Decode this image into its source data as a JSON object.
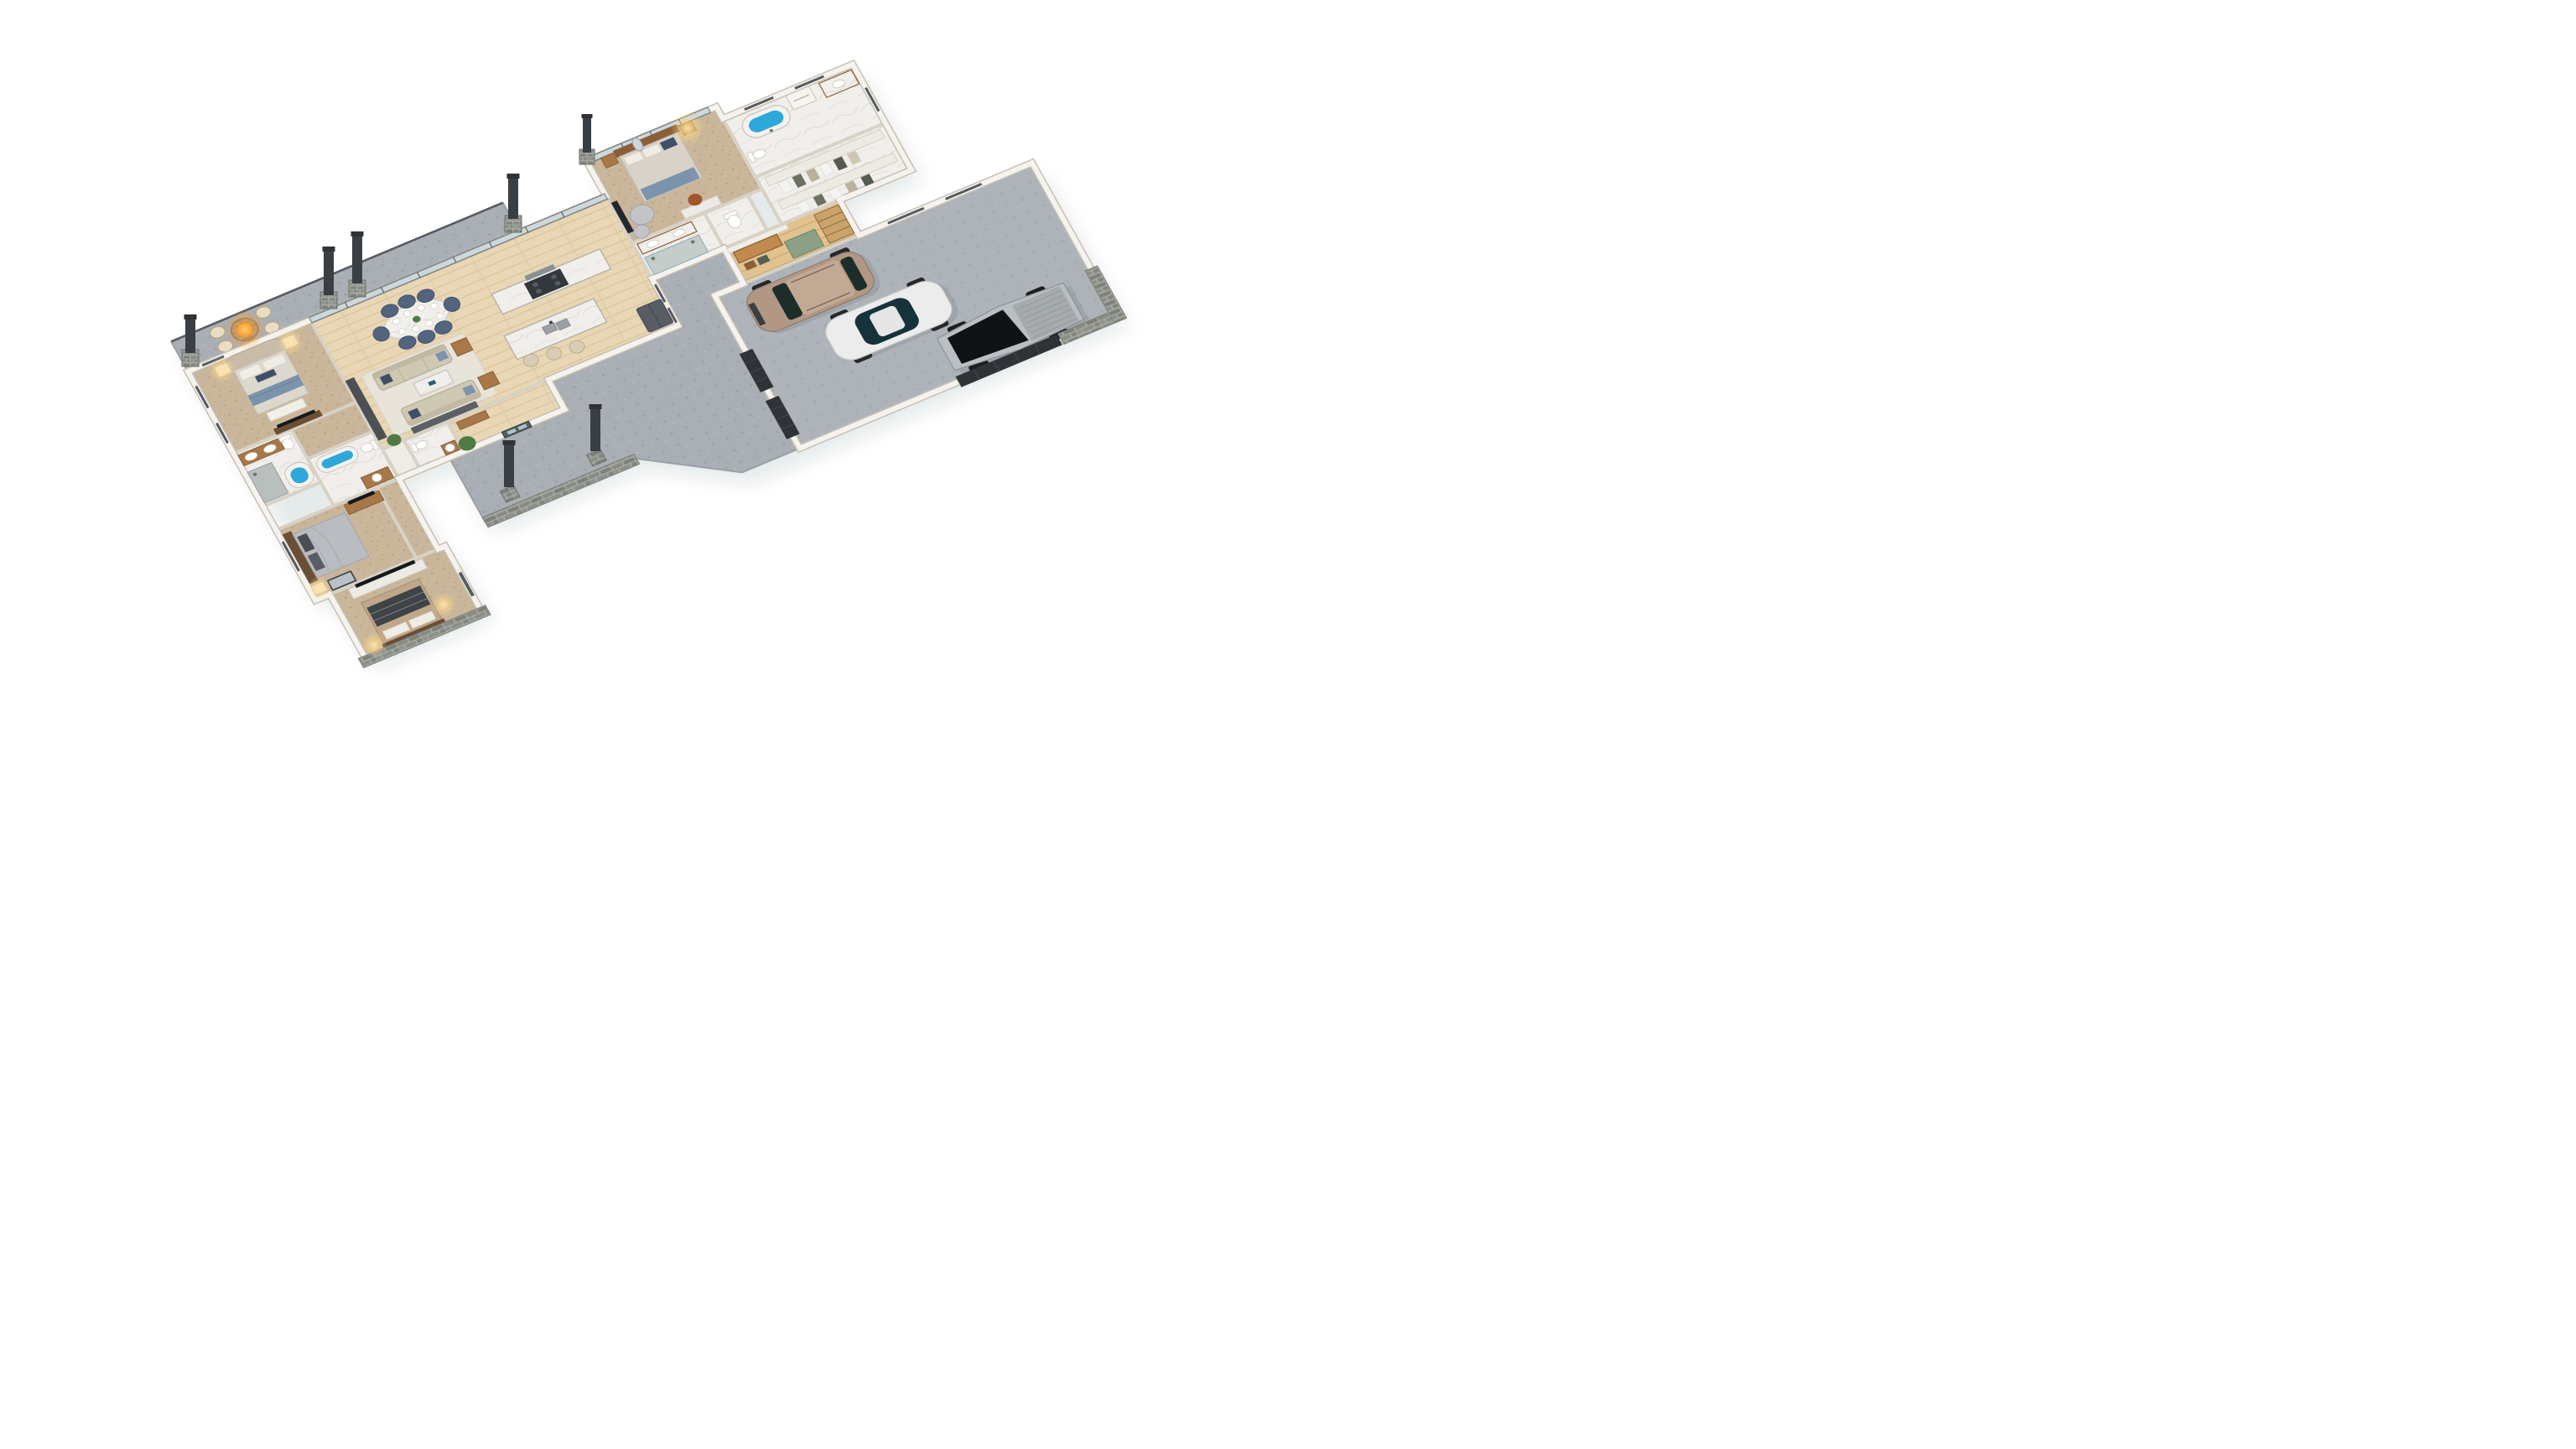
{
  "scene": {
    "title": "3D isometric floor plan render of an L-shaped single-story house",
    "view": "top-down isometric",
    "background_color": "#ffffff"
  },
  "colors": {
    "wood_floor": "#e8d6b4",
    "wood_floor_warm": "#e2c28f",
    "carpet": "#c9b69b",
    "marble_floor": "#f1efeb",
    "marble_top": "#f4f3f0",
    "concrete": "#a9afb5",
    "garage_floor": "#adb3b9",
    "wall": "#f6f3ee",
    "wall_edge": "#c6c0b4",
    "stone": "#8d9088",
    "charcoal": "#2f3337",
    "dark_feature_wall": "#4b5054",
    "navy_chair": "#53647f",
    "sofa_beige": "#cfc8b2",
    "wood_furniture": "#a87848",
    "wood_dark": "#6b4f35",
    "tub_water": "#2da8d8",
    "lamp_glow": "#ffd98a",
    "fire_glow": "#ff9a2a",
    "suv_tan": "#b29884",
    "sedan_white": "#ececec",
    "cybertruck_silver": "#b9bfc3",
    "glass": "#aac3cc",
    "green_cabinet": "#8ba085",
    "plant_green": "#4f7a43",
    "stool_beige": "#d8cdb4",
    "duvet_gray": "#b9bcc0",
    "duvet_blue": "#7c93ad",
    "duvet_tan": "#c0a78c",
    "rug": "#e9e4da"
  },
  "rooms": [
    {
      "name": "master bedroom",
      "floor": "carpet",
      "furniture": [
        "bed with arched headboard",
        "2 nightstands with lit lamps",
        "foot bench",
        "TV console",
        "windows"
      ]
    },
    {
      "name": "master bathroom",
      "floor": "marble",
      "furniture": [
        "double wood vanity",
        "walk-in shower",
        "soaking tub",
        "toilet"
      ]
    },
    {
      "name": "hall bathroom",
      "floor": "marble",
      "furniture": [
        "tub with water",
        "toilet",
        "wood vanity with round sink"
      ]
    },
    {
      "name": "bedroom 2",
      "floor": "carpet",
      "furniture": [
        "bed with gray duvet",
        "nightstand with lamp",
        "leaning mirror",
        "wood TV console"
      ]
    },
    {
      "name": "bedroom 3",
      "floor": "carpet",
      "furniture": [
        "bed with plaid throw",
        "white TV console",
        "2 lit lamps",
        "glass patio door"
      ]
    },
    {
      "name": "open plan living dining kitchen",
      "floor": "light oak wood",
      "furniture": [
        "oval marble dining table with 8 navy chairs",
        "black frame chandelier",
        "2 beige sofas",
        "marble coffee table",
        "area rug",
        "dark feature wall",
        "side tables",
        "media console",
        "kitchen island with double sink",
        "3 bar stools",
        "range with hood and oven",
        "dark refrigerator"
      ]
    },
    {
      "name": "powder room",
      "floor": "marble",
      "furniture": [
        "toilet",
        "round vessel sink on wood vanity"
      ]
    },
    {
      "name": "foyer",
      "floor": "light oak wood",
      "furniture": [
        "console table",
        "potted plant",
        "glass entry door"
      ]
    },
    {
      "name": "guest bedroom",
      "floor": "carpet",
      "furniture": [
        "bed with wood headboard",
        "2 nightstands",
        "lit lamp",
        "swivel armchair with ottoman",
        "TV on half wall",
        "desk with chair",
        "oval mirror"
      ]
    },
    {
      "name": "guest bathroom",
      "floor": "marble",
      "furniture": [
        "double sink vanity",
        "walk-in double shower"
      ]
    },
    {
      "name": "water closet",
      "floor": "marble",
      "furniture": [
        "toilet"
      ]
    },
    {
      "name": "primary bathroom",
      "floor": "marble",
      "furniture": [
        "freestanding tub with blue water",
        "toilet",
        "vanity",
        "washer"
      ]
    },
    {
      "name": "walk-in closet",
      "floor": "marble",
      "furniture": [
        "two rows of open shelves with hanging clothes"
      ]
    },
    {
      "name": "mudroom laundry",
      "floor": "warm wood",
      "furniture": [
        "wood bench with slat wall",
        "baskets",
        "sage green cabinets",
        "wood steps"
      ]
    }
  ],
  "outdoor": {
    "back_deck": {
      "floor": "gray concrete",
      "features": [
        "round fire pit with flame",
        "4 cream armchairs",
        "glass railing",
        "stone pillars with dark chimneys"
      ]
    },
    "front_porch": {
      "floor": "gray concrete",
      "features": [
        "2 freestanding stone pillars with dark posts",
        "stone half wall",
        "driveway apron"
      ]
    }
  },
  "garage": {
    "floor": "gray concrete",
    "door_count": 3,
    "door_color": "#2f3337",
    "vehicles": [
      {
        "type": "SUV",
        "color_name": "tan"
      },
      {
        "type": "sports sedan",
        "color_name": "white"
      },
      {
        "type": "angular electric pickup",
        "color_name": "silver"
      }
    ]
  },
  "counts": {
    "bedrooms": 4,
    "bathrooms": 4,
    "dining_seats": 8,
    "kitchen_stools": 3,
    "patio_chairs": 4,
    "vehicles": 3,
    "chimneys": 7
  }
}
